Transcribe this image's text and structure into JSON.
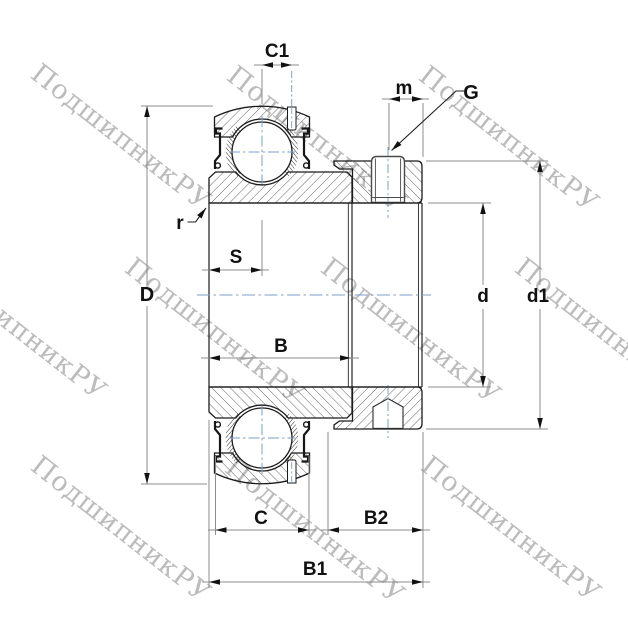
{
  "drawing_type": "bearing cross-section technical drawing (insert ball bearing with eccentric locking collar and set screw)",
  "labels": {
    "c1": "C1",
    "m": "m",
    "g": "G",
    "r": "r",
    "s": "S",
    "big_d": "D",
    "b": "B",
    "d": "d",
    "d1": "d1",
    "c": "C",
    "b2": "B2",
    "b1": "B1"
  },
  "watermark": {
    "text": "ПодшипникРУ",
    "angle_deg": 38,
    "color": "#bcbcbc",
    "positions": [
      {
        "x": 44,
        "y": 58
      },
      {
        "x": 240,
        "y": 60
      },
      {
        "x": 432,
        "y": 60
      },
      {
        "x": -60,
        "y": 248
      },
      {
        "x": 138,
        "y": 252
      },
      {
        "x": 334,
        "y": 252
      },
      {
        "x": 528,
        "y": 252
      },
      {
        "x": 44,
        "y": 450
      },
      {
        "x": 238,
        "y": 452
      },
      {
        "x": 434,
        "y": 450
      }
    ]
  },
  "colors": {
    "outline": "#1b1b1b",
    "hatch": "#3d3d3d",
    "centerline_blue": "#7d9fc9",
    "dimension_gray": "#8d8d8d",
    "arrow_black": "#111111",
    "screw_outline": "#4a4a4a",
    "watermark_gray": "#bcbcbc",
    "background": "#ffffff"
  }
}
